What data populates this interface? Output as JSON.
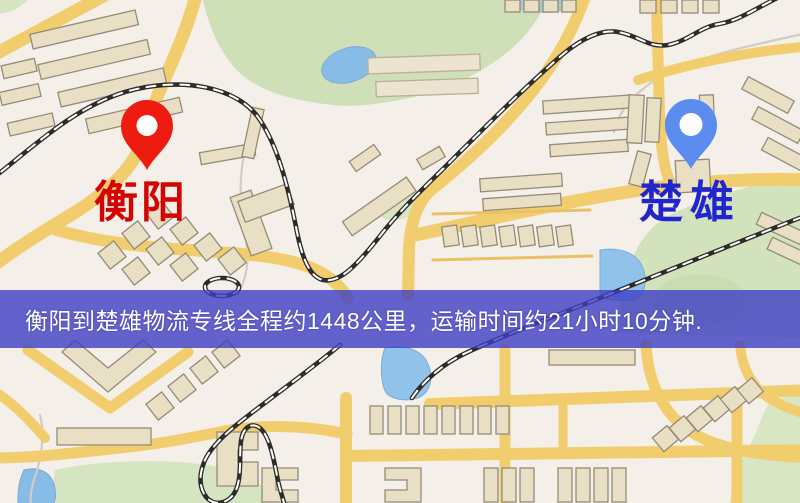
{
  "map_image": {
    "origin": {
      "name": "衡阳",
      "pin_color": "#ed1b10",
      "label_color": "#d60303"
    },
    "destination": {
      "name": "楚雄",
      "pin_color": "#5b8cf0",
      "label_color": "#2126cc"
    },
    "banner": {
      "text": "衡阳到楚雄物流专线全程约1448公里，运输时间约21小时10分钟.",
      "background_color": "#3e3fc4",
      "text_color": "#ffffff"
    }
  }
}
